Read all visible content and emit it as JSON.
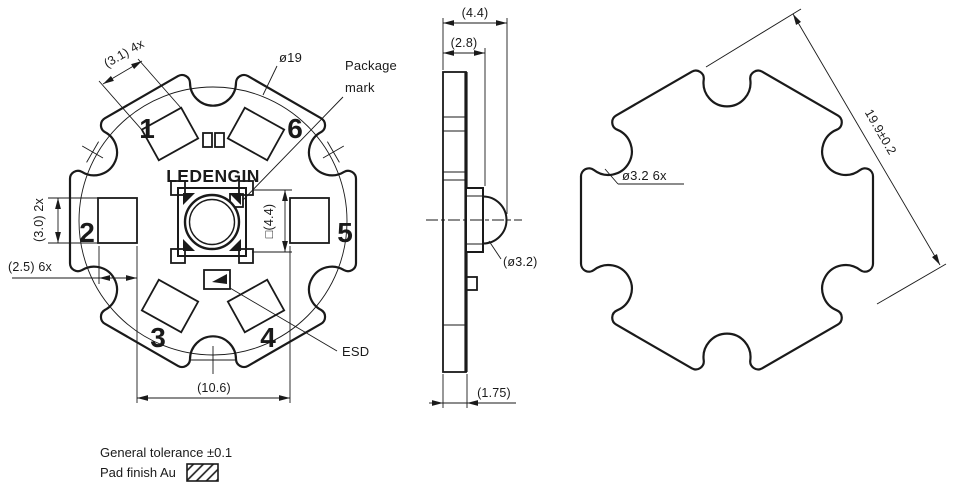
{
  "colors": {
    "ink": "#1a1a1a",
    "background": "#ffffff"
  },
  "top_view": {
    "brand": "LEDENGIN",
    "pads": {
      "n1": "1",
      "n2": "2",
      "n3": "3",
      "n4": "4",
      "n5": "5",
      "n6": "6"
    },
    "dims": {
      "angled_pad_size": "(3.1) 4x",
      "silkscreen_circle_dia": "ø19",
      "package_mark_line1": "Package",
      "package_mark_line2": "mark",
      "package_size": "□(4.4)",
      "square_pad_height": "(3.0) 2x",
      "pad_width": "(2.5) 6x",
      "pad_row_span": "(10.6)",
      "esd_label": "ESD"
    }
  },
  "side_view": {
    "dims": {
      "total_thickness": "(4.4)",
      "body_thickness": "(2.8)",
      "lens_dia": "(ø3.2)",
      "board_thickness": "(1.75)"
    }
  },
  "outline_view": {
    "dims": {
      "notch_dia": "ø3.2 6x",
      "across_flats": "19.9±0.2"
    }
  },
  "notes": {
    "general_tolerance": "General tolerance ±0.1",
    "pad_finish": "Pad finish Au"
  }
}
